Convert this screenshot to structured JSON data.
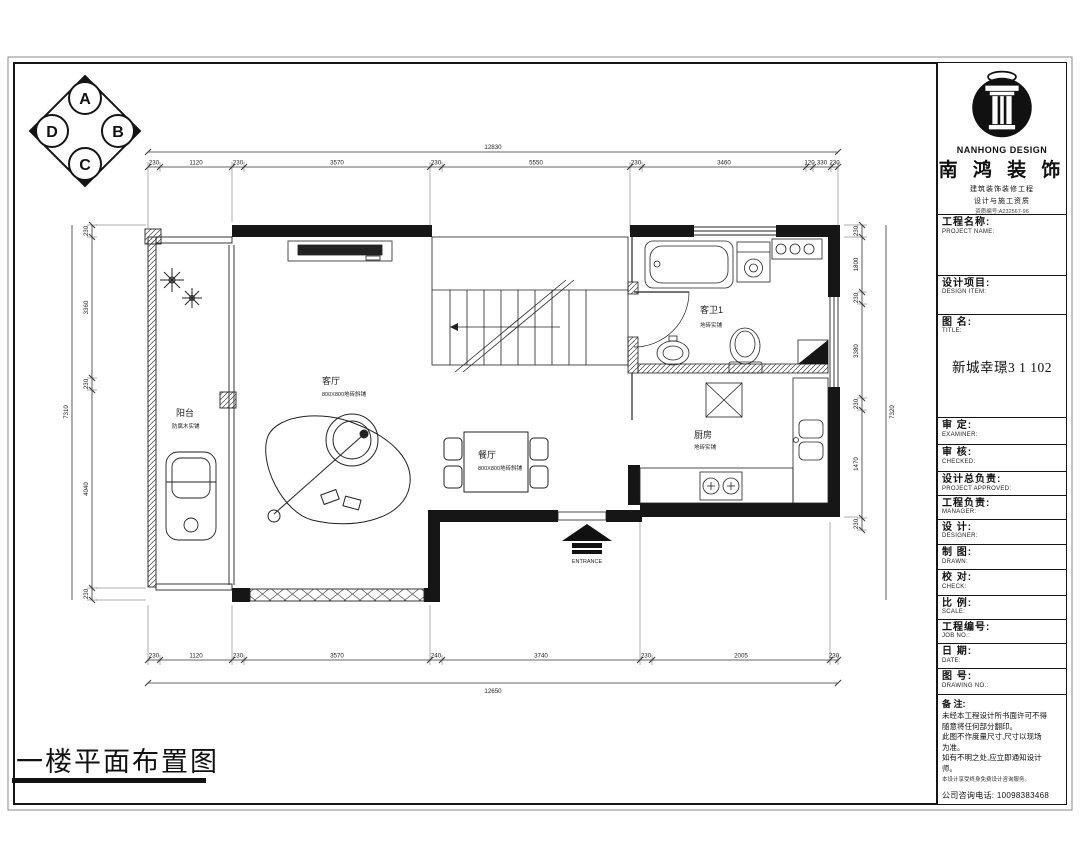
{
  "sheet": {
    "footer_title": "一楼平面布置图"
  },
  "compass": {
    "top": "A",
    "right": "B",
    "bottom": "C",
    "left": "D"
  },
  "logo": {
    "brand_en": "NANHONG DESIGN",
    "brand_cn": "南 鸿 装 饰",
    "cred_line1": "建筑装饰装修工程",
    "cred_line2": "设计与施工资质",
    "cred_line3": "资质编号:A232567-96"
  },
  "title_block": {
    "rows": [
      {
        "label": "工程名称:",
        "sub": "PROJECT NAME:"
      },
      {
        "label": "设计项目:",
        "sub": "DESIGN ITEM:"
      },
      {
        "label": "图  名:",
        "sub": "TITLE:"
      },
      {
        "label": "审  定:",
        "sub": "EXAMINER:"
      },
      {
        "label": "审  核:",
        "sub": "CHECKED:"
      },
      {
        "label": "设计总负责:",
        "sub": "PROJECT APPROVED:"
      },
      {
        "label": "工程负责:",
        "sub": "MANAGER:"
      },
      {
        "label": "设  计:",
        "sub": "DESIGNER:"
      },
      {
        "label": "制  图:",
        "sub": "DRAWN:"
      },
      {
        "label": "校  对:",
        "sub": "CHECK:"
      },
      {
        "label": "比  例:",
        "sub": "SCALE:"
      },
      {
        "label": "工程编号:",
        "sub": "JOB NO.:"
      },
      {
        "label": "日  期:",
        "sub": "DATE:"
      },
      {
        "label": "图  号:",
        "sub": "DRAWING NO.:"
      }
    ],
    "drawing_title": "新城幸璟3 1 102",
    "notes": {
      "label": "备 注:",
      "lines": [
        "未经本工程设计所书面许可不得",
        "随意将任何部分翻印。",
        "此图不作度量尺寸,尺寸以现场",
        "为准。",
        "如有不明之处,应立即通知设计",
        "师。"
      ],
      "small": "本设计享受终身免费设计咨询服务。",
      "phone": "公司咨询电话: 10098383468"
    }
  },
  "plan": {
    "rooms": [
      {
        "name": "阳台",
        "finish": "防腐木实铺"
      },
      {
        "name": "客厅",
        "finish": "800X800地砖斜铺"
      },
      {
        "name": "餐厅",
        "finish": "800X800地砖斜铺"
      },
      {
        "name": "厨房",
        "finish": "地砖实铺"
      },
      {
        "name": "客卫1",
        "finish": "地砖实铺"
      }
    ],
    "entrance_label": "ENTRANCE"
  },
  "dimensions": {
    "top": {
      "total": "12830",
      "segments": [
        "230",
        "1120",
        "230",
        "3570",
        "230",
        "5550",
        "230",
        "3460",
        "120",
        "330",
        "230"
      ]
    },
    "bottom": {
      "total": "12650",
      "segments": [
        "230",
        "1120",
        "230",
        "3570",
        "240",
        "3740",
        "230",
        "2005",
        "230"
      ]
    },
    "left": {
      "total": "7310",
      "segments": [
        "230",
        "3360",
        "230",
        "4040",
        "230"
      ]
    },
    "right": {
      "total": "7320",
      "segments": [
        "230",
        "1800",
        "230",
        "3380",
        "230",
        "1470",
        "230"
      ]
    }
  }
}
